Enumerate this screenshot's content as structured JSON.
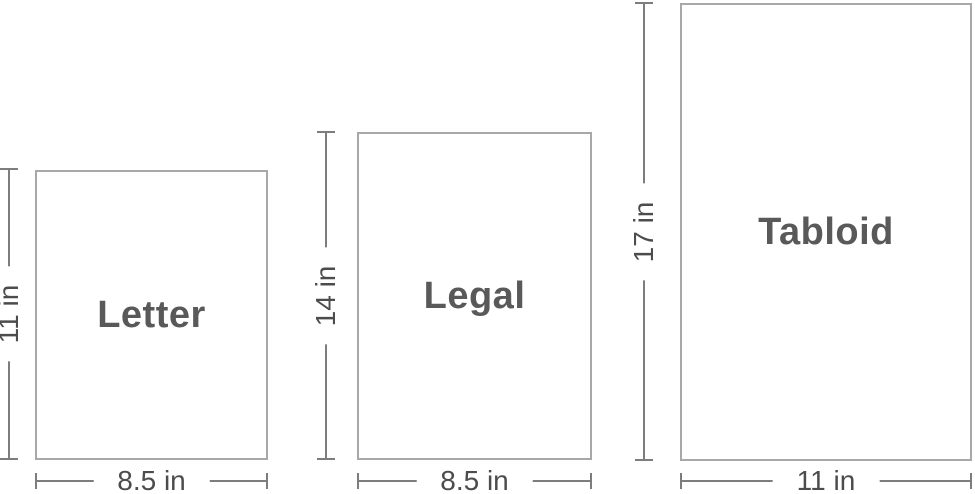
{
  "diagram": {
    "papers": [
      {
        "name": "Letter",
        "height_label": "11 in",
        "width_label": "8.5 in"
      },
      {
        "name": "Legal",
        "height_label": "14 in",
        "width_label": "8.5 in"
      },
      {
        "name": "Tabloid",
        "height_label": "17 in",
        "width_label": "11 in"
      }
    ],
    "colors": {
      "sheet_border": "#a8a8a8",
      "dimension_line": "#7d7d7d",
      "dimension_text": "#4c4c4c",
      "name_text": "#595959",
      "background": "#ffffff"
    }
  }
}
